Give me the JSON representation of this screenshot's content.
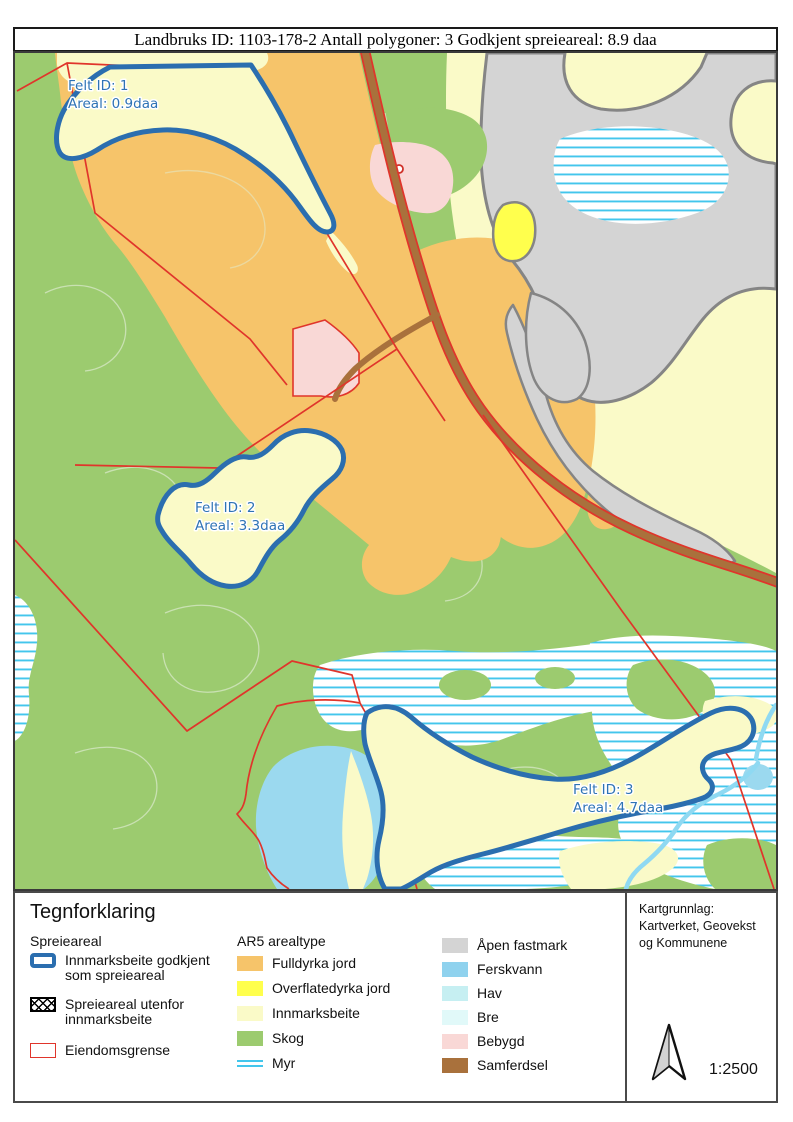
{
  "title_bar": "Landbruks ID: 1103-178-2 Antall polygoner: 3 Godkjent spreieareal: 8.9 daa",
  "map": {
    "fields": [
      {
        "id_label": "Felt ID: 1",
        "areal_label": "Areal: 0.9daa"
      },
      {
        "id_label": "Felt ID: 2",
        "areal_label": "Areal: 3.3daa"
      },
      {
        "id_label": "Felt ID: 3",
        "areal_label": "Areal: 4.7daa"
      }
    ]
  },
  "legend": {
    "title": "Tegnforklaring",
    "spreieareal_header": "Spreieareal",
    "spreieareal_items": [
      {
        "label_line1": "Innmarksbeite godkjent",
        "label_line2": "som spreieareal",
        "swatch": "blue-outline"
      },
      {
        "label_line1": "Spreieareal utenfor",
        "label_line2": "innmarksbeite",
        "swatch": "crosshatch"
      },
      {
        "label_line1": "Eiendomsgrense",
        "label_line2": "",
        "swatch": "red-outline"
      }
    ],
    "ar5_header": "AR5 arealtype",
    "ar5_items": [
      {
        "label": "Fulldyrka jord",
        "color": "#F6C46A"
      },
      {
        "label": "Overflatedyrka jord",
        "color": "#FFFF4D"
      },
      {
        "label": "Innmarksbeite",
        "color": "#FAFAC8"
      },
      {
        "label": "Skog",
        "color": "#9CCB6F"
      },
      {
        "label": "Myr",
        "color": "#43C6EC"
      }
    ],
    "ar5_items2": [
      {
        "label": "Åpen fastmark",
        "color": "#D4D4D4"
      },
      {
        "label": "Ferskvann",
        "color": "#8FD2EE"
      },
      {
        "label": "Hav",
        "color": "#C6EFF2"
      },
      {
        "label": "Bre",
        "color": "#E1F9F9"
      },
      {
        "label": "Bebygd",
        "color": "#F9D8D6"
      },
      {
        "label": "Samferdsel",
        "color": "#A9713C"
      }
    ],
    "attribution_lines": [
      "Kartgrunnlag:",
      "Kartverket, Geovekst",
      "og Kommunene"
    ],
    "scale_text": "1:2500"
  },
  "colors": {
    "field_outline": "#2B6EAF",
    "field_label_text": "#2E73B5",
    "property_line": "#E0352B",
    "road": "#A9713C",
    "lake": "#9BD9EF",
    "myr_stripe": "#43C6EC",
    "gray_border": "#858585"
  }
}
